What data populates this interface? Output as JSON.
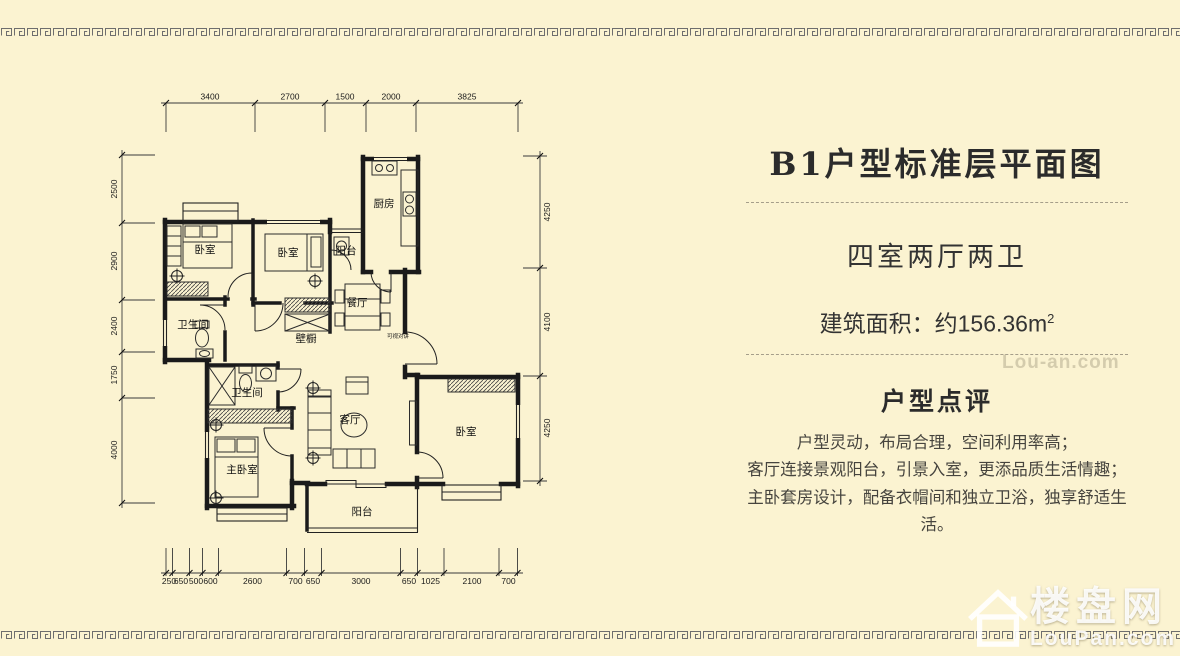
{
  "colors": {
    "background": "#fbf3d1",
    "wall_line": "#1a1a1a",
    "border_pattern": "#6e6e6e",
    "heading_text": "#2b2b2b"
  },
  "panel": {
    "title": "B1户型标准层平面图",
    "layout_type": "四室两厅两卫",
    "area_text": "建筑面积：约156.36m",
    "area_sup": "2",
    "review_title": "户型点评",
    "review_lines": [
      "户型灵动，布局合理，空间利用率高；",
      "客厅连接景观阳台，引景入室，更添品质生活情趣；",
      "主卧套房设计，配备衣帽间和独立卫浴，独享舒适生活。"
    ]
  },
  "plan": {
    "room_labels": {
      "bedroom1": "卧室",
      "bedroom2": "卧室",
      "kitchen": "厨房",
      "balcony_north": "阳台",
      "dining": "餐厅",
      "bath1": "卫生间",
      "closet": "壁橱",
      "bath2": "卫生间",
      "master": "主卧室",
      "living": "客厅",
      "bedroom3": "卧室",
      "balcony_south": "阳台",
      "intercom": "可视对讲"
    },
    "dims": {
      "top": [
        "3400",
        "2700",
        "1500",
        "2000",
        "3825"
      ],
      "left": [
        "2500",
        "2900",
        "2400",
        "1750",
        "4000"
      ],
      "right": [
        "4250",
        "4100",
        "4250"
      ],
      "bottom": [
        "250",
        "650",
        "500",
        "600",
        "2600",
        "700",
        "650",
        "3000",
        "650",
        "1025",
        "2100",
        "700"
      ]
    }
  },
  "watermark": {
    "name": "楼盘网",
    "domain": "LouPan.com",
    "faint": "Lou-an.com"
  }
}
